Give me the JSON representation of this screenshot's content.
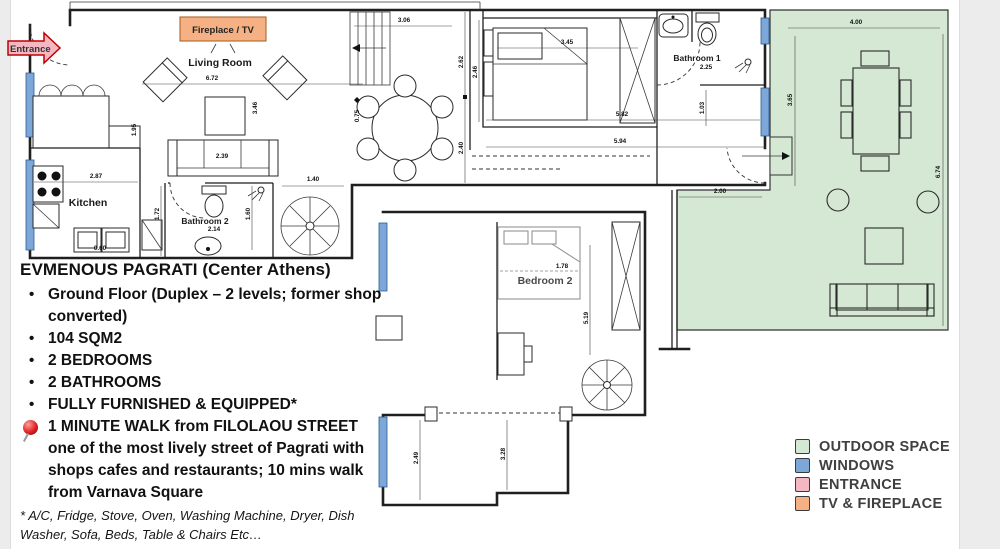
{
  "colors": {
    "outdoor": "#d5e8d4",
    "windows": "#7da7d9",
    "entrance": "#f4b8c2",
    "tvfire": "#f5b183"
  },
  "plan": {
    "labels": {
      "entrance": "Entrance",
      "fireplace_tv": "Fireplace / TV",
      "living_room": "Living Room",
      "kitchen": "Kitchen",
      "bathroom2": "Bathroom 2",
      "bedroom1": "Bedroom 1",
      "bathroom1": "Bathroom 1",
      "bedroom2": "Bedroom 2"
    },
    "dims": {
      "living_width": "6.72",
      "living_depth": "3.46",
      "sofa": "2.39",
      "kitchen_wall": "1.95",
      "kitchen_width": "2.87",
      "appliance": "0.60",
      "bath2_depth": "1.72",
      "bath2_width": "2.14",
      "bath2_right": "1.60",
      "stair_width": "1.40",
      "dining_top": "3.06",
      "dining_marker": "0.75",
      "hall_upper": "2.62",
      "hall_lower": "2.40",
      "bed1_width": "3.45",
      "bed1_depth": "2.46",
      "bed1_lower": "5.82",
      "upper_total": "5.94",
      "bath1_width": "2.25",
      "bath1_door": "1.03",
      "outdoor_top": "4.00",
      "outdoor_left": "3.65",
      "outdoor_right": "6.74",
      "outdoor_gap": "2.00",
      "bed2_width": "1.78",
      "bed2_depth": "5.19",
      "low_left": "2.49",
      "low_mid": "3.28"
    }
  },
  "description": {
    "title": "EVMENOUS PAGRATI (Center Athens)",
    "bullets": [
      "Ground Floor (Duplex – 2 levels; former shop converted)",
      "104 SQM2",
      "2 BEDROOMS",
      "2 BATHROOMS",
      "FULLY FURNISHED & EQUIPPED*"
    ],
    "highlight": "1 MINUTE WALK from FILOLAOU STREET one of the most lively street of Pagrati with shops cafes and restaurants; 10 mins walk from Varnava Square",
    "footnote": "* A/C, Fridge, Stove, Oven, Washing Machine, Dryer, Dish Washer, Sofa, Beds, Table & Chairs Etc…"
  },
  "legend": {
    "items": [
      {
        "label": "OUTDOOR SPACE"
      },
      {
        "label": "WINDOWS"
      },
      {
        "label": "ENTRANCE"
      },
      {
        "label": "TV & FIREPLACE"
      }
    ]
  }
}
